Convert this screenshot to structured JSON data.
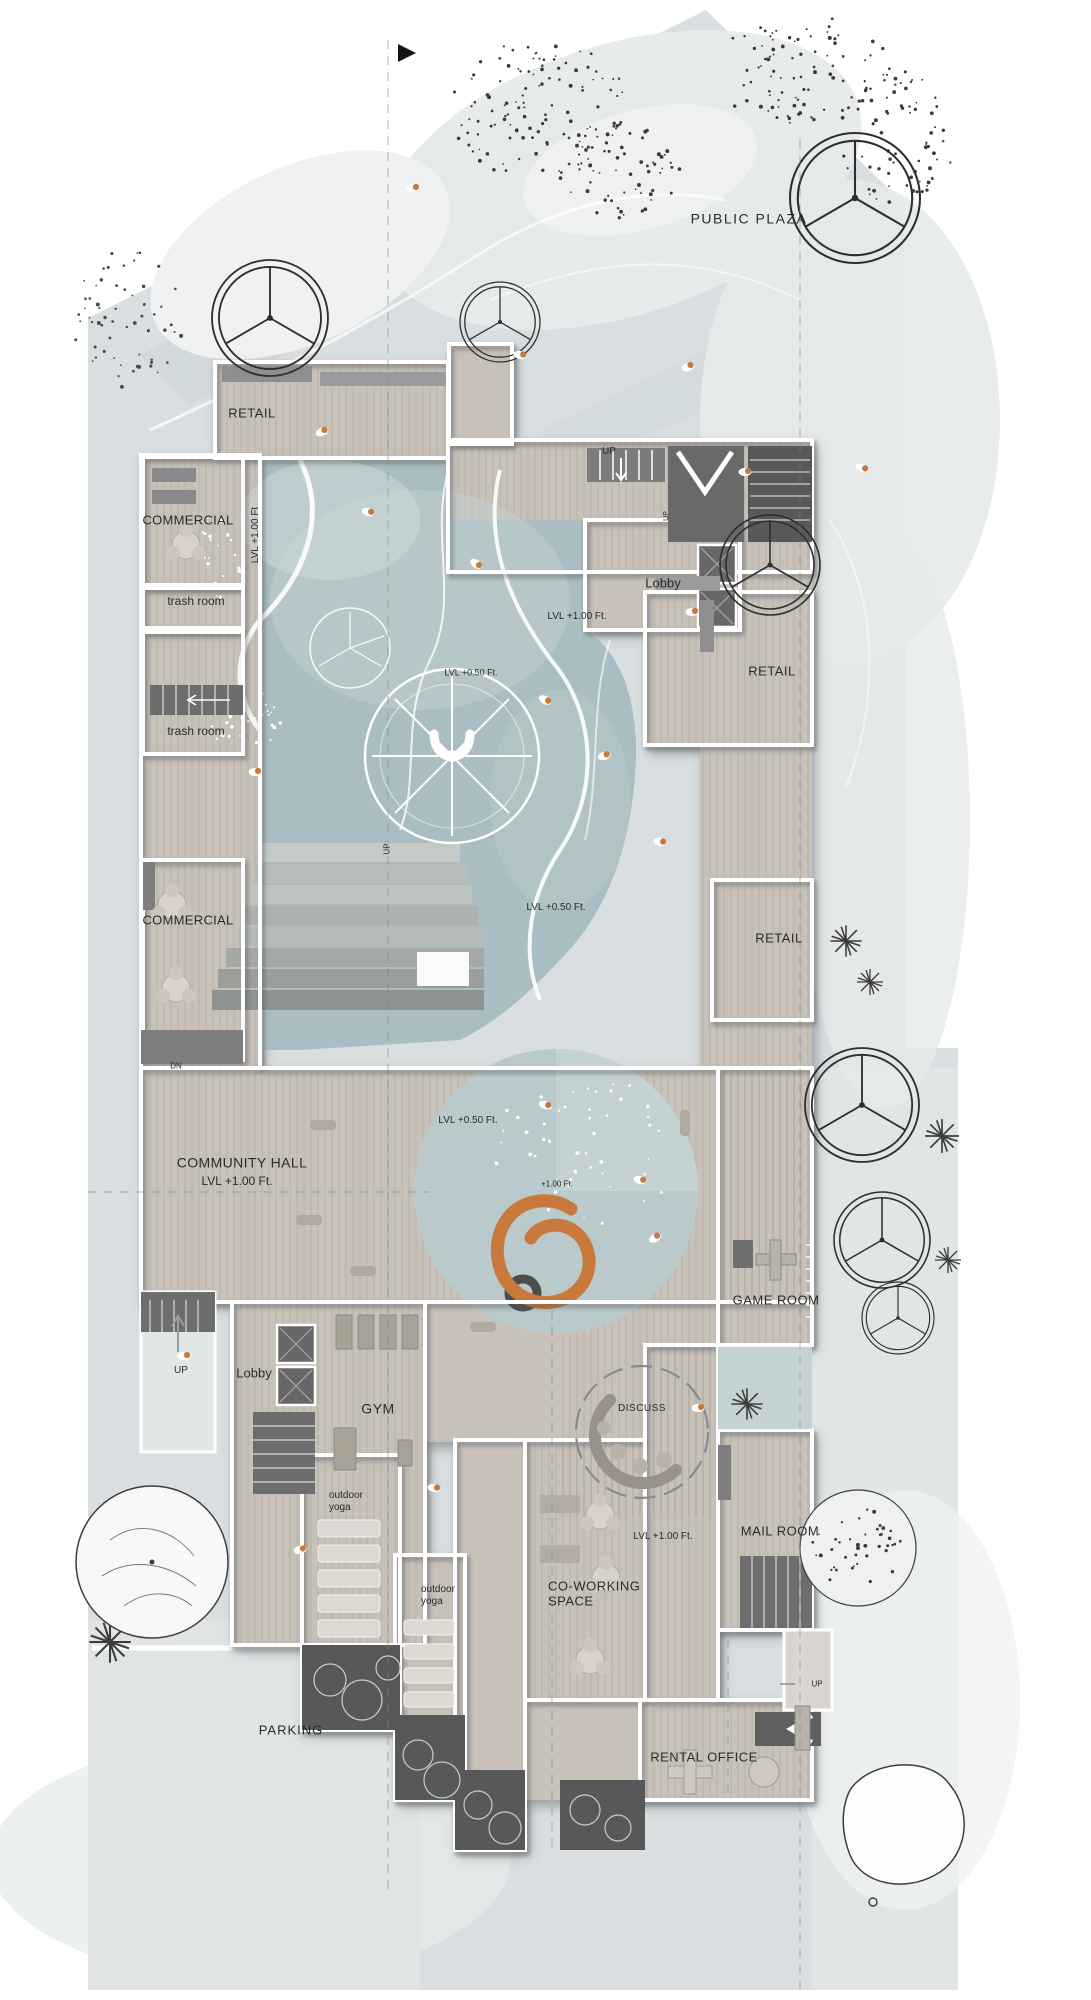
{
  "drawing": {
    "type": "architectural-ground-floor-site-plan"
  },
  "colors": {
    "site": "#d9dfe1",
    "blob": "#e6eaea",
    "blob2": "#eff1f2",
    "streak": "#cfd7d9",
    "floor": "#c8c1b8",
    "water": "#a9bdc2",
    "water_light": "#c5d2d2",
    "plaza": "#bac9cc",
    "wall": "#ffffff",
    "service": "#6d6d6d",
    "service_dark": "#585858",
    "accent": "#c8793b",
    "ink": "#2b2b2b",
    "parking": "#e0e4e5",
    "ramp": "#e3e6e7"
  },
  "icons": {
    "north_arrow": "north-arrow-icon"
  },
  "labels": [
    {
      "id": "public-plaza",
      "text": "PUBLIC PLAZA",
      "x": 749,
      "y": 219,
      "fs": 14,
      "ls": 1.5
    },
    {
      "id": "retail-top",
      "text": "RETAIL",
      "x": 252,
      "y": 413,
      "fs": 13,
      "ls": 0.5
    },
    {
      "id": "commercial-upper",
      "text": "COMMERCIAL",
      "x": 188,
      "y": 520,
      "fs": 13,
      "ls": 0.3
    },
    {
      "id": "lvl-corridor",
      "text": "LVL +1.00 Ft",
      "x": 256,
      "y": 535,
      "fs": 10,
      "rot": -90
    },
    {
      "id": "trash-room-upper",
      "text": "trash room",
      "x": 196,
      "y": 601,
      "fs": 12
    },
    {
      "id": "trash-room-lower",
      "text": "trash room",
      "x": 196,
      "y": 731,
      "fs": 12
    },
    {
      "id": "commercial-lower",
      "text": "COMMERCIAL",
      "x": 188,
      "y": 920,
      "fs": 13,
      "ls": 0.3
    },
    {
      "id": "up-entry",
      "text": "UP",
      "x": 609,
      "y": 452,
      "fs": 10
    },
    {
      "id": "up-entry-side",
      "text": "UP",
      "x": 667,
      "y": 516,
      "fs": 7,
      "rot": -90
    },
    {
      "id": "lobby-upper",
      "text": "Lobby",
      "x": 663,
      "y": 583,
      "fs": 13
    },
    {
      "id": "lvl-entry",
      "text": "LVL +1.00 Ft.",
      "x": 577,
      "y": 617,
      "fs": 10
    },
    {
      "id": "retail-east-upper",
      "text": "RETAIL",
      "x": 772,
      "y": 671,
      "fs": 13,
      "ls": 0.5
    },
    {
      "id": "lvl-court-upper",
      "text": "LVL +0.50 Ft.",
      "x": 471,
      "y": 673,
      "fs": 9
    },
    {
      "id": "up-terrace",
      "text": "UP",
      "x": 387,
      "y": 849,
      "fs": 8,
      "rot": -90
    },
    {
      "id": "lvl-court-lower",
      "text": "LVL +0.50 Ft.",
      "x": 556,
      "y": 908,
      "fs": 10
    },
    {
      "id": "retail-east-lower",
      "text": "RETAIL",
      "x": 779,
      "y": 938,
      "fs": 13,
      "ls": 0.5
    },
    {
      "id": "dn-west",
      "text": "DN",
      "x": 176,
      "y": 1066,
      "fs": 8
    },
    {
      "id": "lvl-plaza",
      "text": "LVL +0.50 Ft.",
      "x": 468,
      "y": 1121,
      "fs": 10
    },
    {
      "id": "community-hall",
      "text": "COMMUNITY HALL",
      "x": 242,
      "y": 1163,
      "fs": 14,
      "ls": 0.4
    },
    {
      "id": "lvl-hall",
      "text": "LVL +1.00 Ft.",
      "x": 237,
      "y": 1181,
      "fs": 12
    },
    {
      "id": "lvl-circle",
      "text": "+1.00 Ft.",
      "x": 557,
      "y": 1184,
      "fs": 8
    },
    {
      "id": "game-room",
      "text": "GAME ROOM",
      "x": 776,
      "y": 1300,
      "fs": 13,
      "ls": 0.5
    },
    {
      "id": "up-ramp",
      "text": "UP",
      "x": 181,
      "y": 1371,
      "fs": 10
    },
    {
      "id": "lobby-lower",
      "text": "Lobby",
      "x": 254,
      "y": 1373,
      "fs": 13
    },
    {
      "id": "gym",
      "text": "GYM",
      "x": 378,
      "y": 1409,
      "fs": 14,
      "ls": 0.5
    },
    {
      "id": "discuss",
      "text": "DISCUSS",
      "x": 642,
      "y": 1409,
      "fs": 10,
      "ls": 0.5
    },
    {
      "id": "outdoor-yoga-west",
      "text": "outdoor\nyoga",
      "x": 329,
      "y": 1502,
      "fs": 10,
      "anchor": "left"
    },
    {
      "id": "mail-room",
      "text": "MAIL ROOM",
      "x": 780,
      "y": 1531,
      "fs": 13,
      "ls": 0.5
    },
    {
      "id": "lvl-cowork",
      "text": "LVL +1.00 Ft.",
      "x": 663,
      "y": 1537,
      "fs": 10
    },
    {
      "id": "co-working",
      "text": "CO-WORKING\nSPACE",
      "x": 548,
      "y": 1594,
      "fs": 13,
      "anchor": "left",
      "ls": 0.5
    },
    {
      "id": "outdoor-yoga-south",
      "text": "outdoor\nyoga",
      "x": 421,
      "y": 1596,
      "fs": 10,
      "anchor": "left"
    },
    {
      "id": "parking",
      "text": "PARKING",
      "x": 291,
      "y": 1730,
      "fs": 13,
      "ls": 1
    },
    {
      "id": "rental-office",
      "text": "RENTAL OFFICE",
      "x": 704,
      "y": 1757,
      "fs": 13,
      "ls": 0.5
    },
    {
      "id": "up-southeast",
      "text": "UP",
      "x": 817,
      "y": 1684,
      "fs": 8
    }
  ]
}
